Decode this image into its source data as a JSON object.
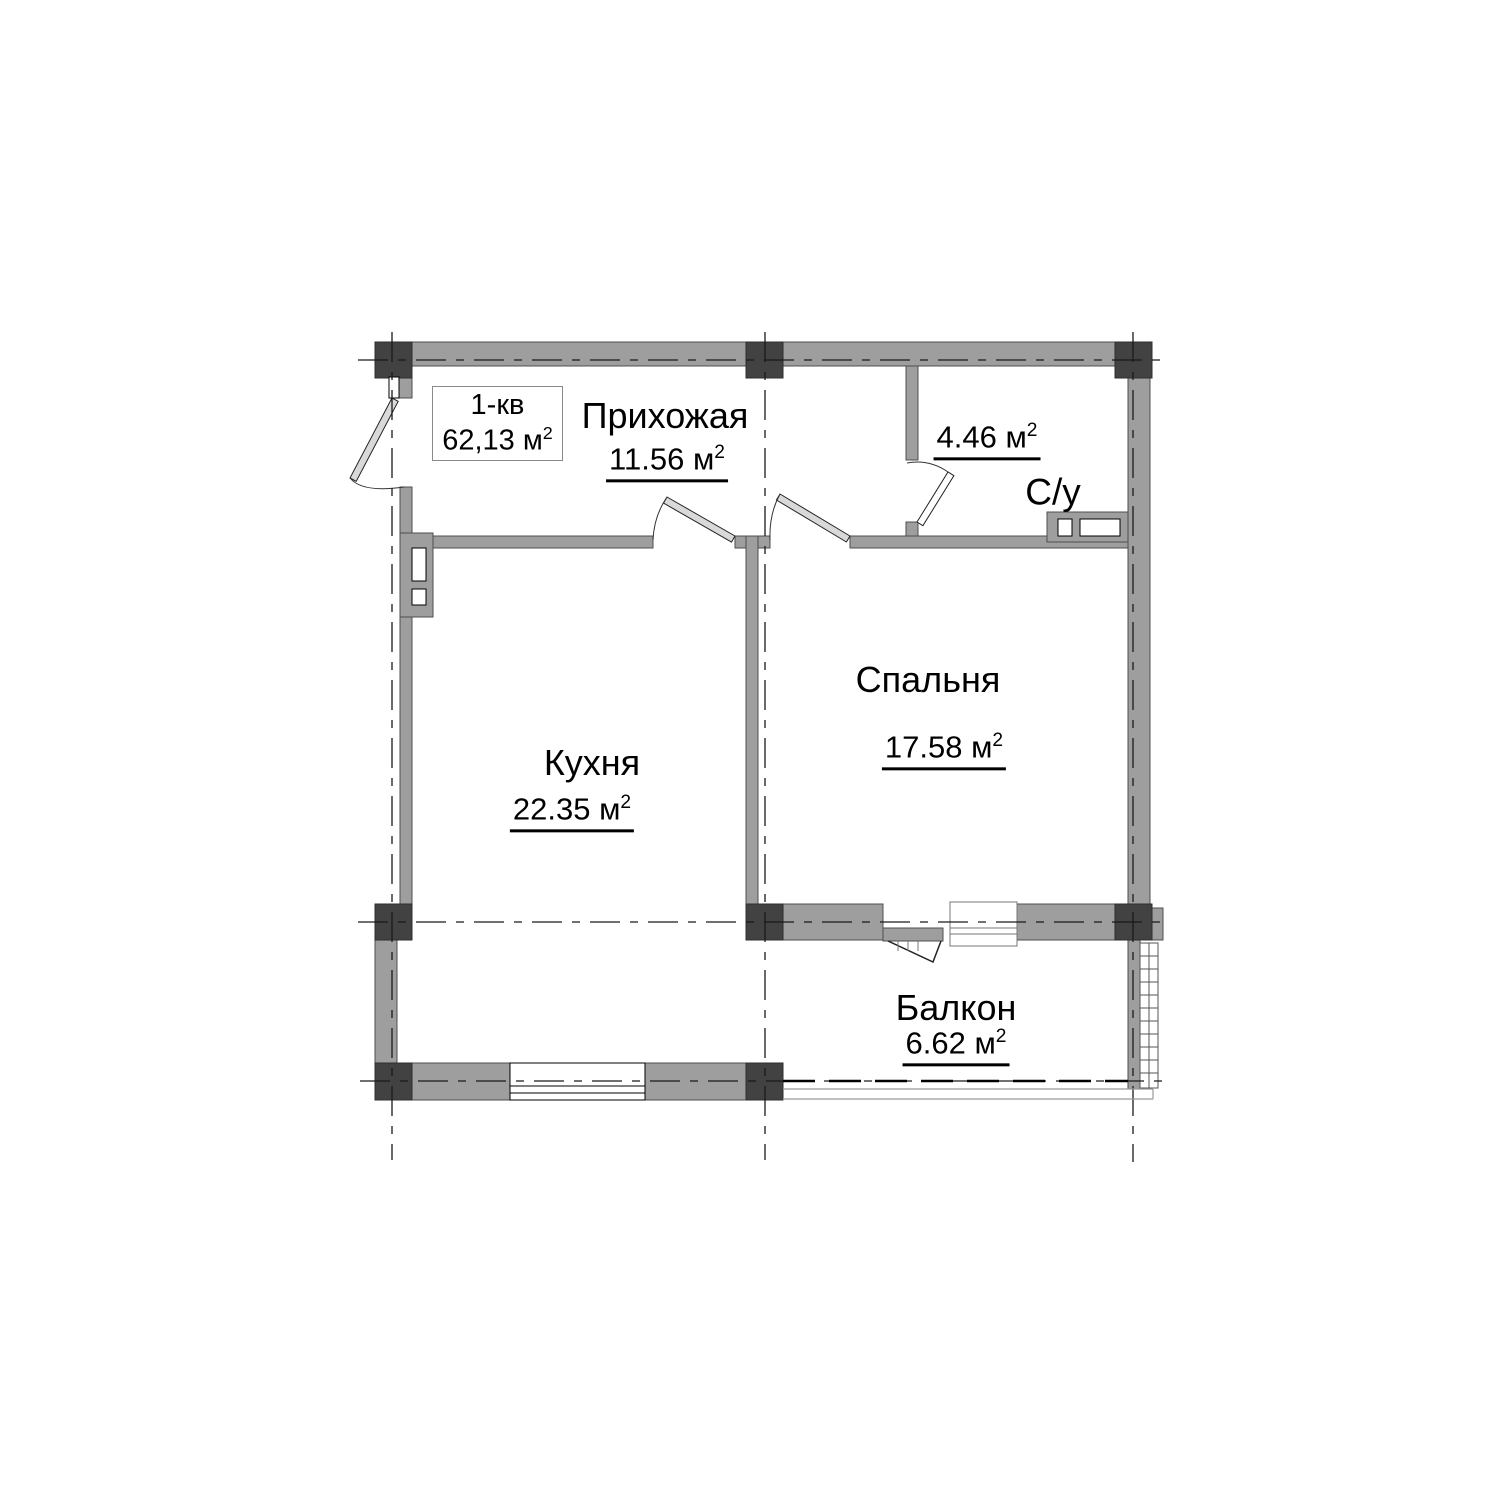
{
  "unit_info": {
    "name": "1-кв",
    "area": "62,13 м",
    "area_sup": "2"
  },
  "rooms": [
    {
      "name": "Прихожая",
      "area": "11.56 м",
      "area_sup": "2"
    },
    {
      "name": "С/у",
      "area": "4.46 м",
      "area_sup": "2"
    },
    {
      "name": "Спальня",
      "area": "17.58 м",
      "area_sup": "2"
    },
    {
      "name": "Кухня",
      "area": "22.35 м",
      "area_sup": "2"
    },
    {
      "name": "Балкон",
      "area": "6.62 м",
      "area_sup": "2"
    }
  ],
  "colors": {
    "wall_fill": "#9e9e9e",
    "column_fill": "#424242",
    "outline": "#4f4f4f",
    "axis_line": "#1a1a1a",
    "text": "#000000",
    "background": "#ffffff"
  }
}
